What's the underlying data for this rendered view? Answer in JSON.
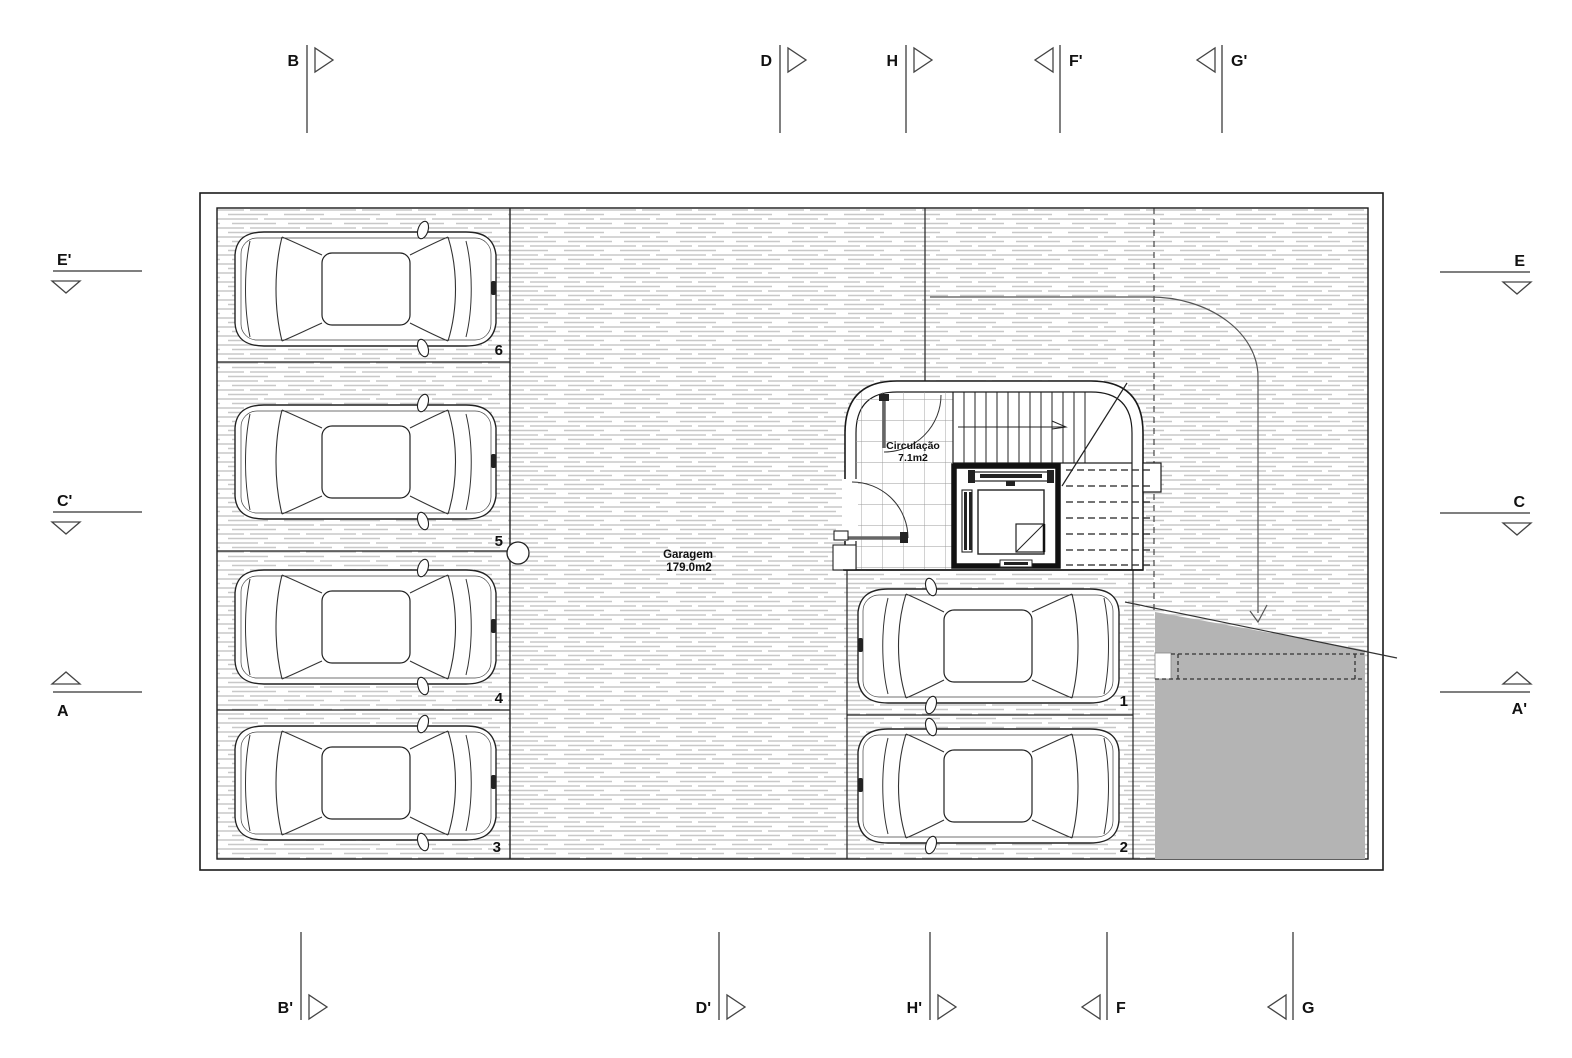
{
  "rooms": {
    "garage": {
      "name": "Garagem",
      "area": "179.0m2"
    },
    "circulation": {
      "name": "Circulação",
      "area": "7.1m2"
    }
  },
  "parking": {
    "space1": "1",
    "space2": "2",
    "space3": "3",
    "space4": "4",
    "space5": "5",
    "space6": "6"
  },
  "section_markers": {
    "top": {
      "b": "B",
      "d": "D",
      "h": "H",
      "f_prime": "F'",
      "g_prime": "G'"
    },
    "bottom": {
      "b_prime": "B'",
      "d_prime": "D'",
      "h_prime": "H'",
      "f": "F",
      "g": "G"
    },
    "left": {
      "e_prime": "E'",
      "c_prime": "C'",
      "a": "A"
    },
    "right": {
      "e": "E",
      "c": "C",
      "a_prime": "A'"
    }
  },
  "colors": {
    "ramp_gray": "#b4b4b4",
    "hatch_gray": "#c8c8c8",
    "line_dark": "#1a1a1a"
  }
}
